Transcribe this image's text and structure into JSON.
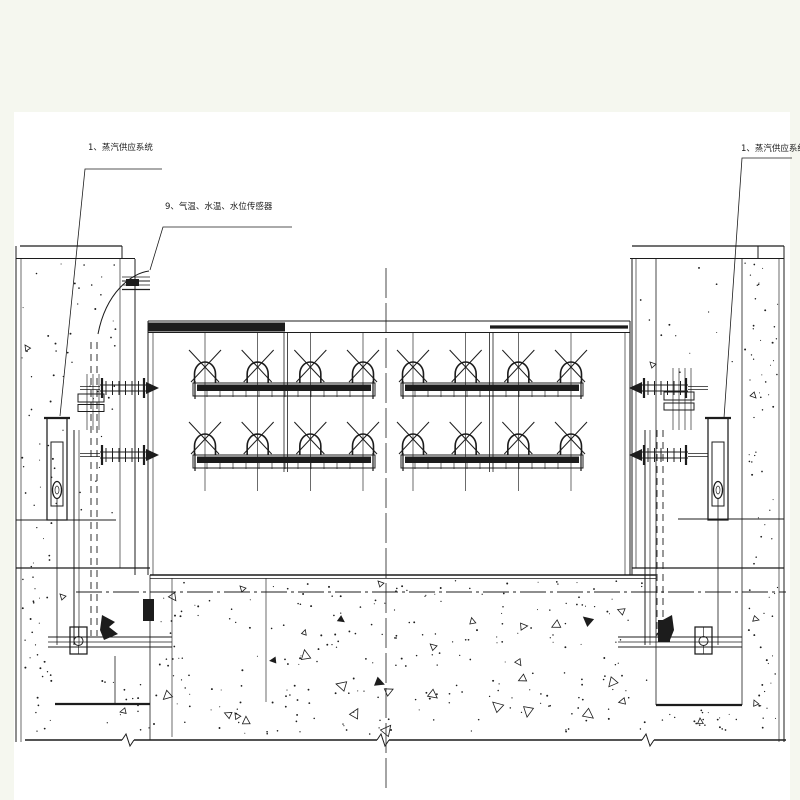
{
  "palette": {
    "page_background": "#f5f7ef",
    "sheet": "#ffffff",
    "ink": "#1c1c1c"
  },
  "labels": {
    "steam_supply_left": "1、蒸汽供应系统",
    "sensors": "9、气温、水温、水位传感器",
    "steam_supply_right": "1、蒸汽供应系统"
  },
  "figure": {
    "pipe_groups": 2,
    "rows_per_group": 2,
    "loops_per_row": 4
  }
}
